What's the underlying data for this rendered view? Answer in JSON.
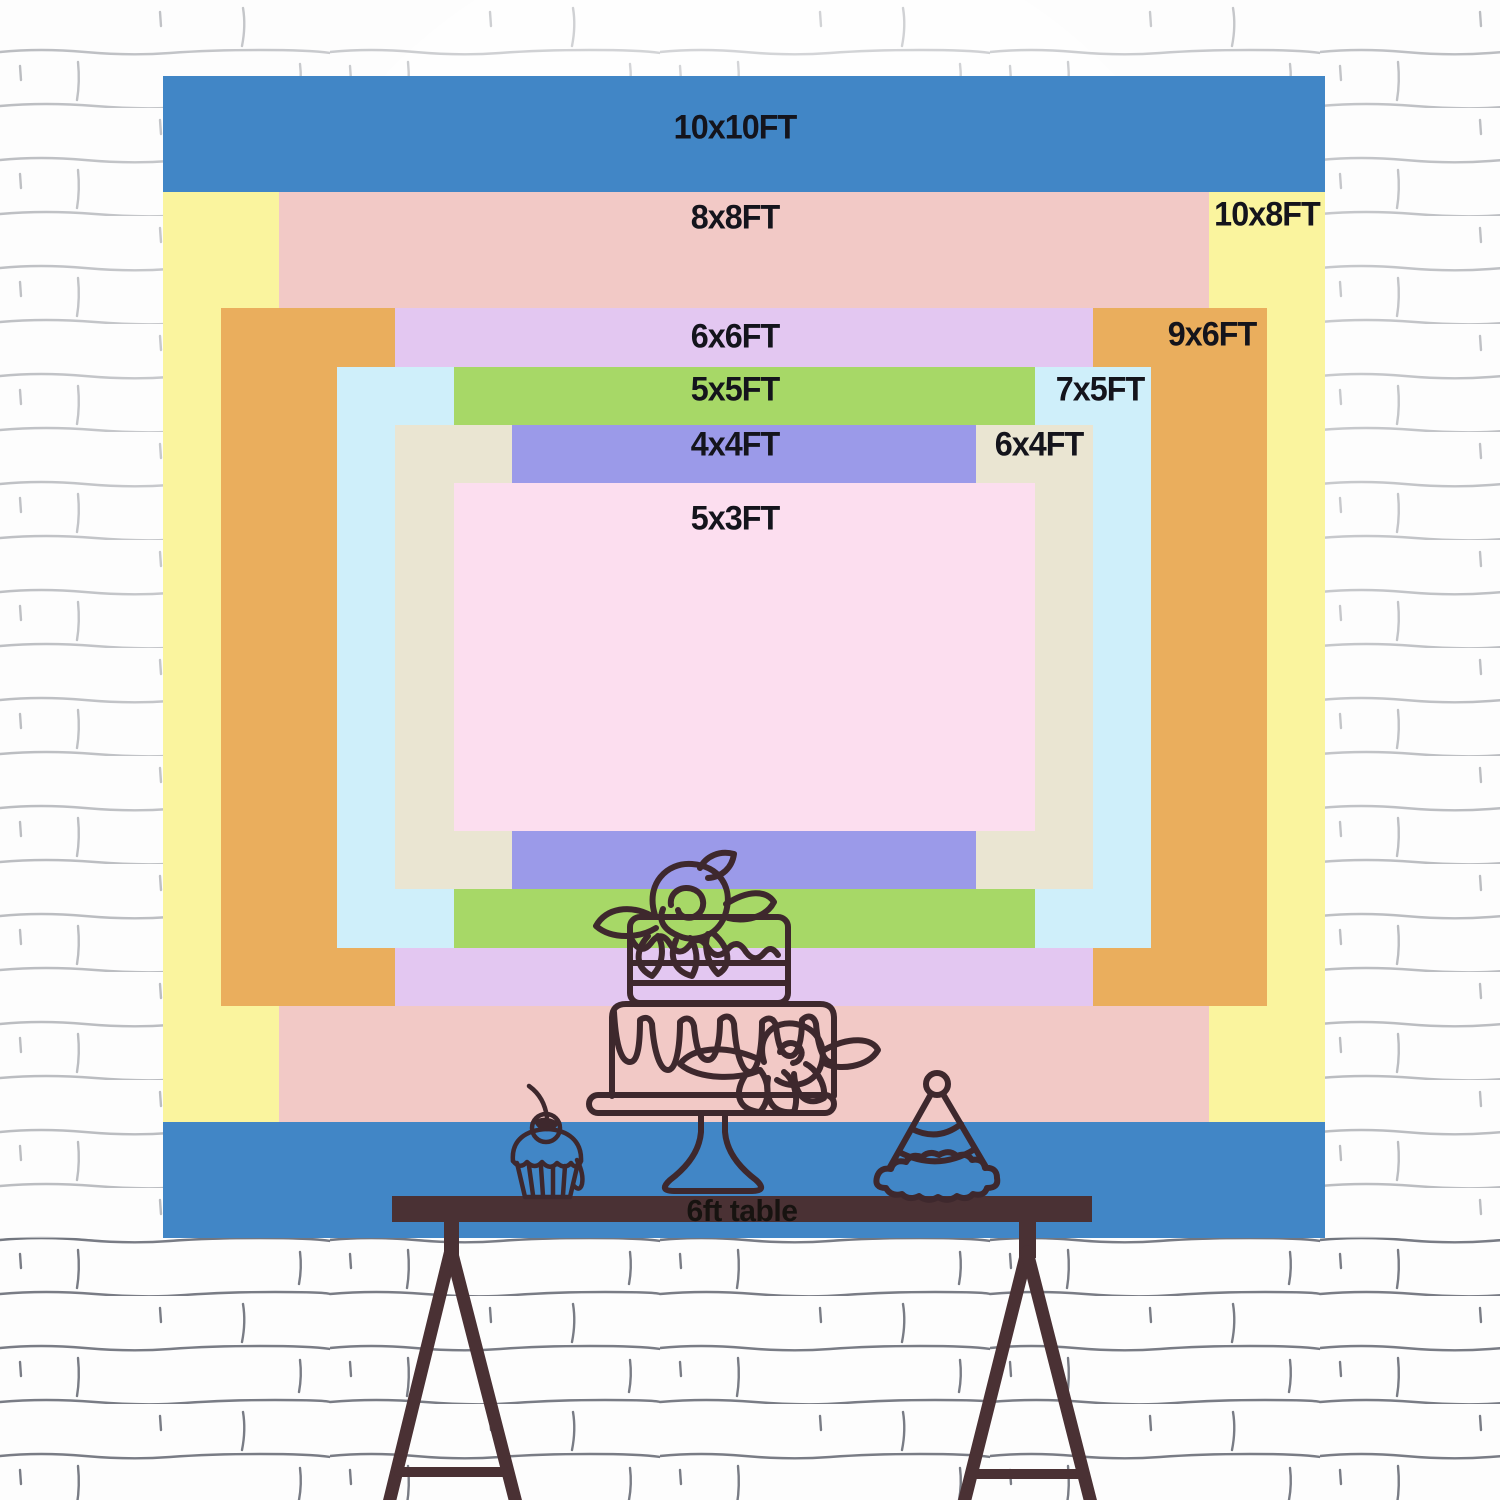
{
  "page": {
    "title": "Backdrop size comparison chart"
  },
  "layout_scale": {
    "px_per_ft": 116.2,
    "center_x": 744,
    "center_y": 657
  },
  "backdrop_sizes": [
    {
      "label": "10x10FT",
      "width_ft": 10,
      "height_ft": 10,
      "color": "#4186c6",
      "label_anchor": "top-center",
      "label_dx": -9,
      "label_dy": 52
    },
    {
      "label": "10x8FT",
      "width_ft": 10,
      "height_ft": 8,
      "color": "#faf49e",
      "label_anchor": "top-right",
      "label_dx": 58,
      "label_dy": 23
    },
    {
      "label": "8x8FT",
      "width_ft": 8,
      "height_ft": 8,
      "color": "#f2c9c6",
      "label_anchor": "top-center",
      "label_dx": -9,
      "label_dy": 26
    },
    {
      "label": "9x6FT",
      "width_ft": 9,
      "height_ft": 6,
      "color": "#eaae5d",
      "label_anchor": "top-right",
      "label_dx": 55,
      "label_dy": 27
    },
    {
      "label": "6x6FT",
      "width_ft": 6,
      "height_ft": 6,
      "color": "#e3c7f1",
      "label_anchor": "top-center",
      "label_dx": -9,
      "label_dy": 29
    },
    {
      "label": "7x5FT",
      "width_ft": 7,
      "height_ft": 5,
      "color": "#cfeffa",
      "label_anchor": "top-right",
      "label_dx": 51,
      "label_dy": 23
    },
    {
      "label": "5x5FT",
      "width_ft": 5,
      "height_ft": 5,
      "color": "#a7d867",
      "label_anchor": "top-center",
      "label_dx": -9,
      "label_dy": 23
    },
    {
      "label": "6x4FT",
      "width_ft": 6,
      "height_ft": 4,
      "color": "#eae5d2",
      "label_anchor": "top-right",
      "label_dx": 54,
      "label_dy": 20
    },
    {
      "label": "4x4FT",
      "width_ft": 4,
      "height_ft": 4,
      "color": "#9b9ae9",
      "label_anchor": "top-center",
      "label_dx": -9,
      "label_dy": 20
    },
    {
      "label": "5x3FT",
      "width_ft": 5,
      "height_ft": 3,
      "color": "#fcdeef",
      "label_anchor": "top-center",
      "label_dx": -9,
      "label_dy": 36
    }
  ],
  "table": {
    "label": "6ft table",
    "bar_color": "#4a3134",
    "label_color": "#171310"
  },
  "colors": {
    "label_text": "#14141c",
    "line_art": "#3e282d",
    "trestle": "#4a3134",
    "wall_base": "#fdfdfd",
    "wall_line": "#6a6e78"
  },
  "decorations": [
    {
      "name": "left-trestle"
    },
    {
      "name": "right-trestle"
    },
    {
      "name": "cupcake"
    },
    {
      "name": "tiered-cake"
    },
    {
      "name": "party-hat"
    }
  ]
}
